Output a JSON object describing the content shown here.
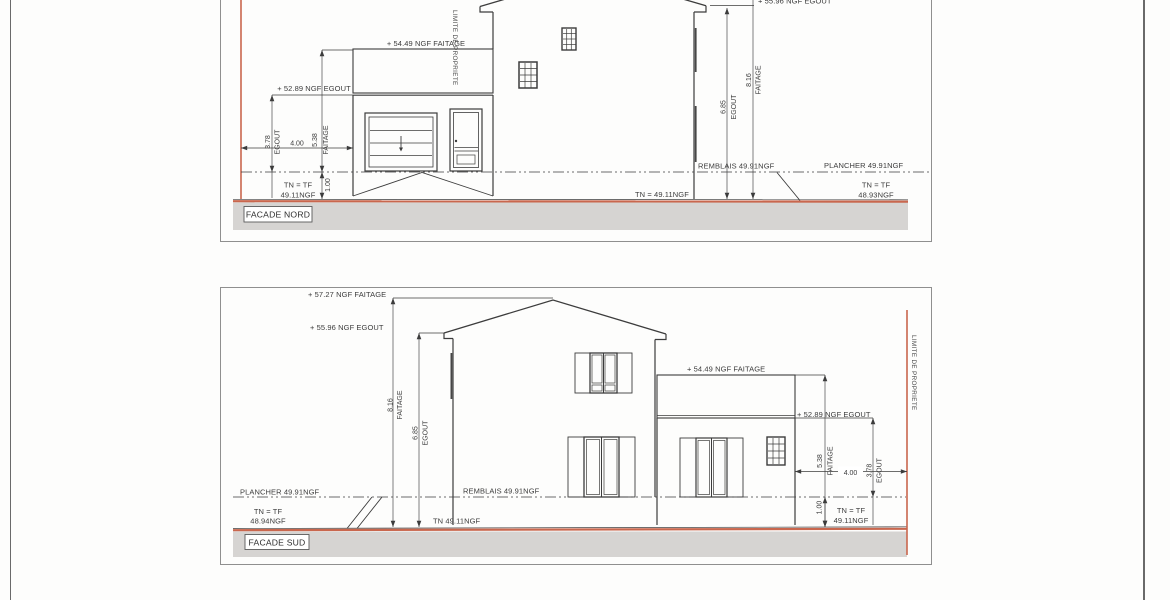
{
  "colors": {
    "ink": "#3c3c3c",
    "red": "#c9674e",
    "gstrip": "#d6d4d2",
    "border": "#8f8f8f",
    "paper": "#fdfdfc"
  },
  "facade_nord": {
    "title": "FACADE NORD",
    "limite": "LIMITE DE PROPRIETE",
    "levels": {
      "faitage_garage": "+ 54.49 NGF FAITAGE",
      "egout_garage": "+ 52.89 NGF EGOUT",
      "egout_house_clipped": "+ 55.96 NGF EGOUT",
      "remblais": "REMBLAIS 49.91NGF",
      "plancher": "PLANCHER 49.91NGF",
      "tn_left_1": "TN = TF",
      "tn_left_2": "49.11NGF",
      "tn_mid": "TN = 49.11NGF",
      "tn_right_1": "TN = TF",
      "tn_right_2": "48.93NGF"
    },
    "dims": {
      "d378": "3.78",
      "d378_w": "EGOUT",
      "d400": "4.00",
      "d538": "5.38",
      "d538_w": "FAITAGE",
      "d100": "1.00",
      "d685": "6.85",
      "d685_w": "EGOUT",
      "d816": "8.16",
      "d816_w": "FAITAGE"
    }
  },
  "facade_sud": {
    "title": "FACADE SUD",
    "limite": "LIMITE DE PROPRIETE",
    "levels": {
      "faitage_house": "+ 57.27 NGF FAITAGE",
      "egout_house": "+ 55.96 NGF EGOUT",
      "faitage_garage": "+ 54.49 NGF FAITAGE",
      "egout_garage": "+ 52.89 NGF EGOUT",
      "plancher": "PLANCHER 49.91NGF",
      "remblais": "REMBLAIS 49.91NGF",
      "tn_left_1": "TN = TF",
      "tn_left_2": "48.94NGF",
      "tn_mid": "TN 49.11NGF",
      "tn_right_1": "TN = TF",
      "tn_right_2": "49.11NGF"
    },
    "dims": {
      "d816": "8.16",
      "d816_w": "FAITAGE",
      "d685": "6.85",
      "d685_w": "EGOUT",
      "d538": "5.38",
      "d538_w": "FAITAGE",
      "d100": "1.00",
      "d400": "4.00",
      "d378": "3.78",
      "d378_w": "EGOUT"
    }
  }
}
